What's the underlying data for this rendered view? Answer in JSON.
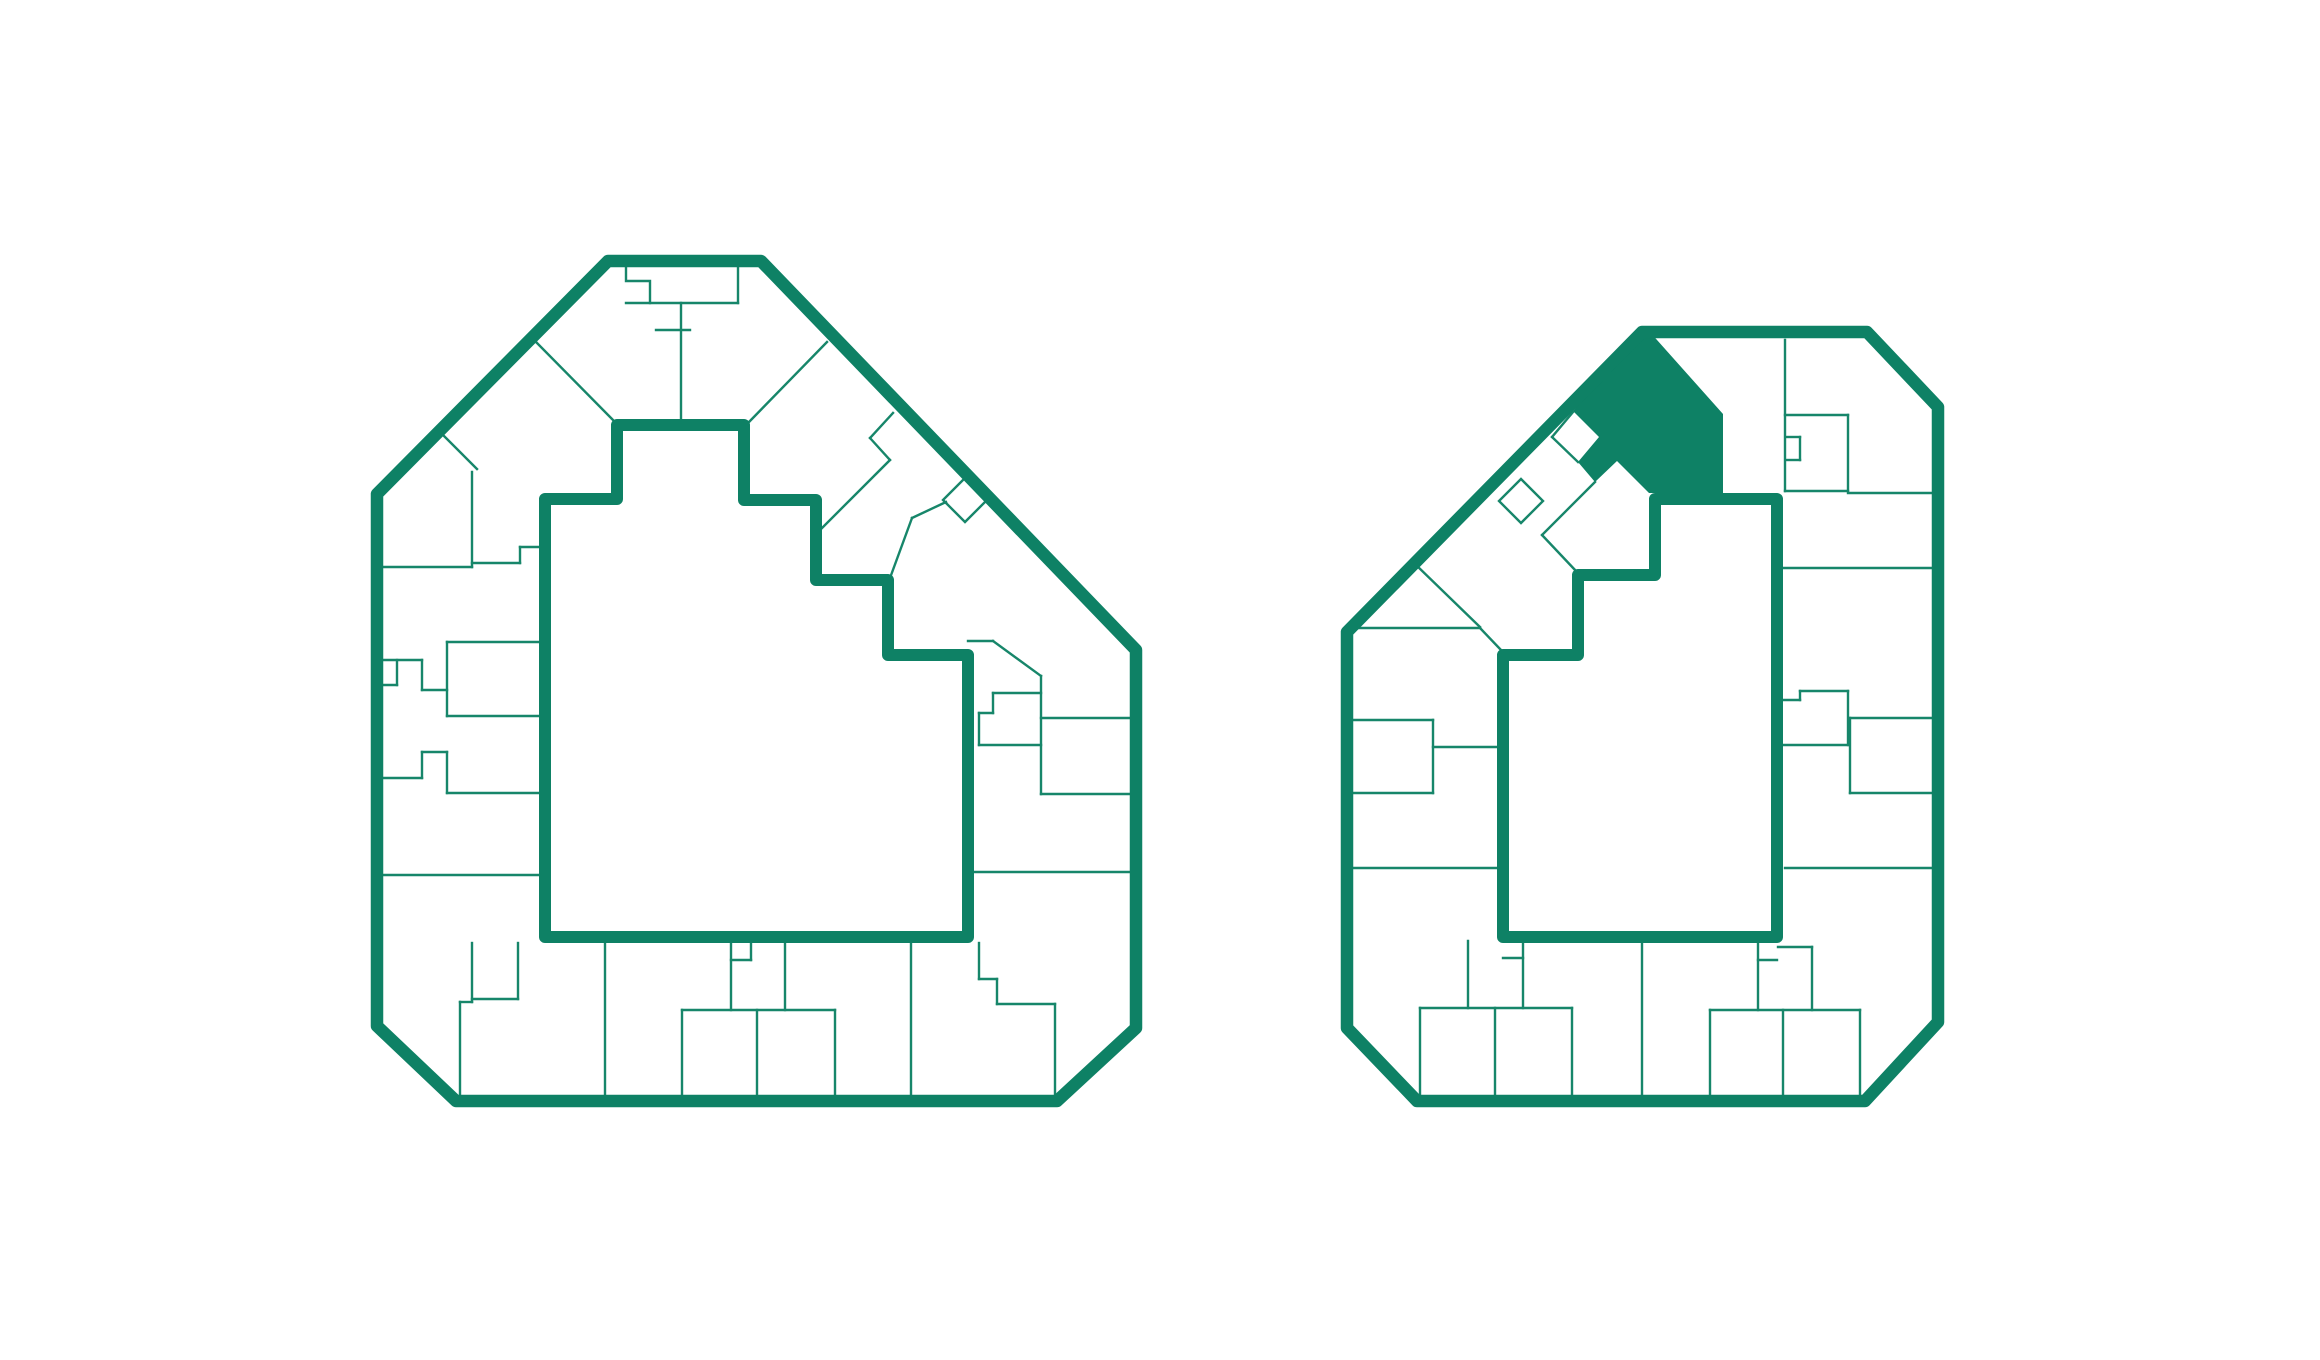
{
  "canvas": {
    "width": 2320,
    "height": 1360,
    "background": "#ffffff"
  },
  "palette": {
    "wall_color": "#0e8165",
    "thin_line_color": "#17866a",
    "highlight_fill": "#0e8165",
    "outer_wall_width": 12.5,
    "courtyard_wall_width": 12,
    "thin_line_width": 2.4
  },
  "plans": [
    {
      "id": "left",
      "label": "large-floor-plan",
      "outer_wall": "608,261 761,261 1136,650 1136,1028 1057,1101 456,1101 377,1026 377,494",
      "courtyard_wall": "617,425 744,425 744,500 816,500 816,580 888,580 888,655 968,655 968,937 545,937 545,499 617,499",
      "highlight_unit": "",
      "unit_lines": [
        "626,263 626,281 650,281 650,303",
        "626,303 738,303",
        "738,263 738,303",
        "656,330 690,330",
        "681,303 681,425",
        "536,342 615,422",
        "827,342 748,423",
        "440,432 477,469",
        "472,472 472,567",
        "383,567 472,567",
        "472,563 520,563",
        "520,547 520,563",
        "520,547 542,547",
        "383,660 422,660",
        "397,660 397,685",
        "383,685 397,685",
        "422,660 422,690",
        "422,690 447,690",
        "447,642 447,716",
        "447,642 542,642",
        "447,716 542,716",
        "383,778 422,778",
        "422,752 422,778",
        "422,752 447,752",
        "447,752 447,793",
        "447,793 542,793",
        "383,875 542,875",
        "460,1002 472,1002",
        "460,1002 460,1101",
        "472,943 472,1002",
        "472,999 518,999",
        "518,943 518,999",
        "605,943 605,1101",
        "731,943 731,1010",
        "731,960 751,960",
        "751,943 751,960",
        "682,1010 835,1010",
        "682,1010 682,1101",
        "757,1010 757,1101",
        "835,1010 835,1101",
        "785,943 785,1010",
        "911,943 911,1101",
        "979,943 979,979",
        "979,979 997,979",
        "997,979 997,1004",
        "997,1004 1055,1004",
        "1055,1004 1055,1101",
        "893,413 870,438",
        "870,438 890,460",
        "890,460 818,532",
        "965,478 987,500 965,522 943,500 965,478",
        "946,502 912,518",
        "912,518 890,578",
        "968,641 993,641",
        "993,641 1041,676",
        "1041,676 1041,794",
        "993,693 1041,693",
        "993,693 993,713",
        "979,713 993,713",
        "979,713 979,745",
        "979,745 1041,745",
        "1041,718 1134,718",
        "1041,794 1134,794",
        "968,872 1134,872"
      ]
    },
    {
      "id": "right",
      "label": "small-floor-plan",
      "outer_wall": "1642,332 1867,332 1938,407 1938,1022 1865,1101 1417,1101 1347,1028 1347,632",
      "courtyard_wall": "1655,499 1777,499 1777,937 1503,937 1503,655 1578,655 1578,575 1655,575",
      "highlight_unit": "1573,411 1642,331 1649,331 1723,414 1723,493 1649,493 1617,461 1595,482 1578,462 1599,437",
      "unit_lines": [
        "1785,340 1785,491",
        "1785,415 1848,415",
        "1848,415 1848,491",
        "1785,491 1848,491",
        "1848,493 1936,493",
        "1787,437 1800,437",
        "1800,437 1800,460",
        "1787,460 1800,460",
        "1779,568 1936,568",
        "1783,700 1800,700",
        "1800,691 1800,700",
        "1800,691 1848,691",
        "1848,691 1848,745",
        "1783,745 1848,745",
        "1850,718 1936,718",
        "1850,718 1850,793",
        "1850,793 1936,793",
        "1785,868 1936,868",
        "1349,720 1433,720",
        "1433,720 1433,793",
        "1349,793 1433,793",
        "1433,747 1501,747",
        "1349,868 1501,868",
        "1415,564 1480,627",
        "1352,628 1480,628",
        "1480,628 1501,650",
        "1521,479 1543,501 1521,523 1499,501 1521,479",
        "1595,482 1542,535",
        "1542,535 1576,571",
        "1578,462 1552,437",
        "1552,437 1573,412",
        "1523,941 1523,1008",
        "1503,958 1523,958",
        "1468,941 1468,1008",
        "1420,1008 1572,1008",
        "1420,1008 1420,1101",
        "1495,1008 1495,1101",
        "1572,1008 1572,1101",
        "1642,941 1642,1101",
        "1758,941 1758,1010",
        "1758,960 1777,960",
        "1778,947 1812,947",
        "1812,947 1812,1010",
        "1710,1010 1860,1010",
        "1710,1010 1710,1101",
        "1783,1010 1783,1101",
        "1860,1010 1860,1101"
      ]
    }
  ]
}
